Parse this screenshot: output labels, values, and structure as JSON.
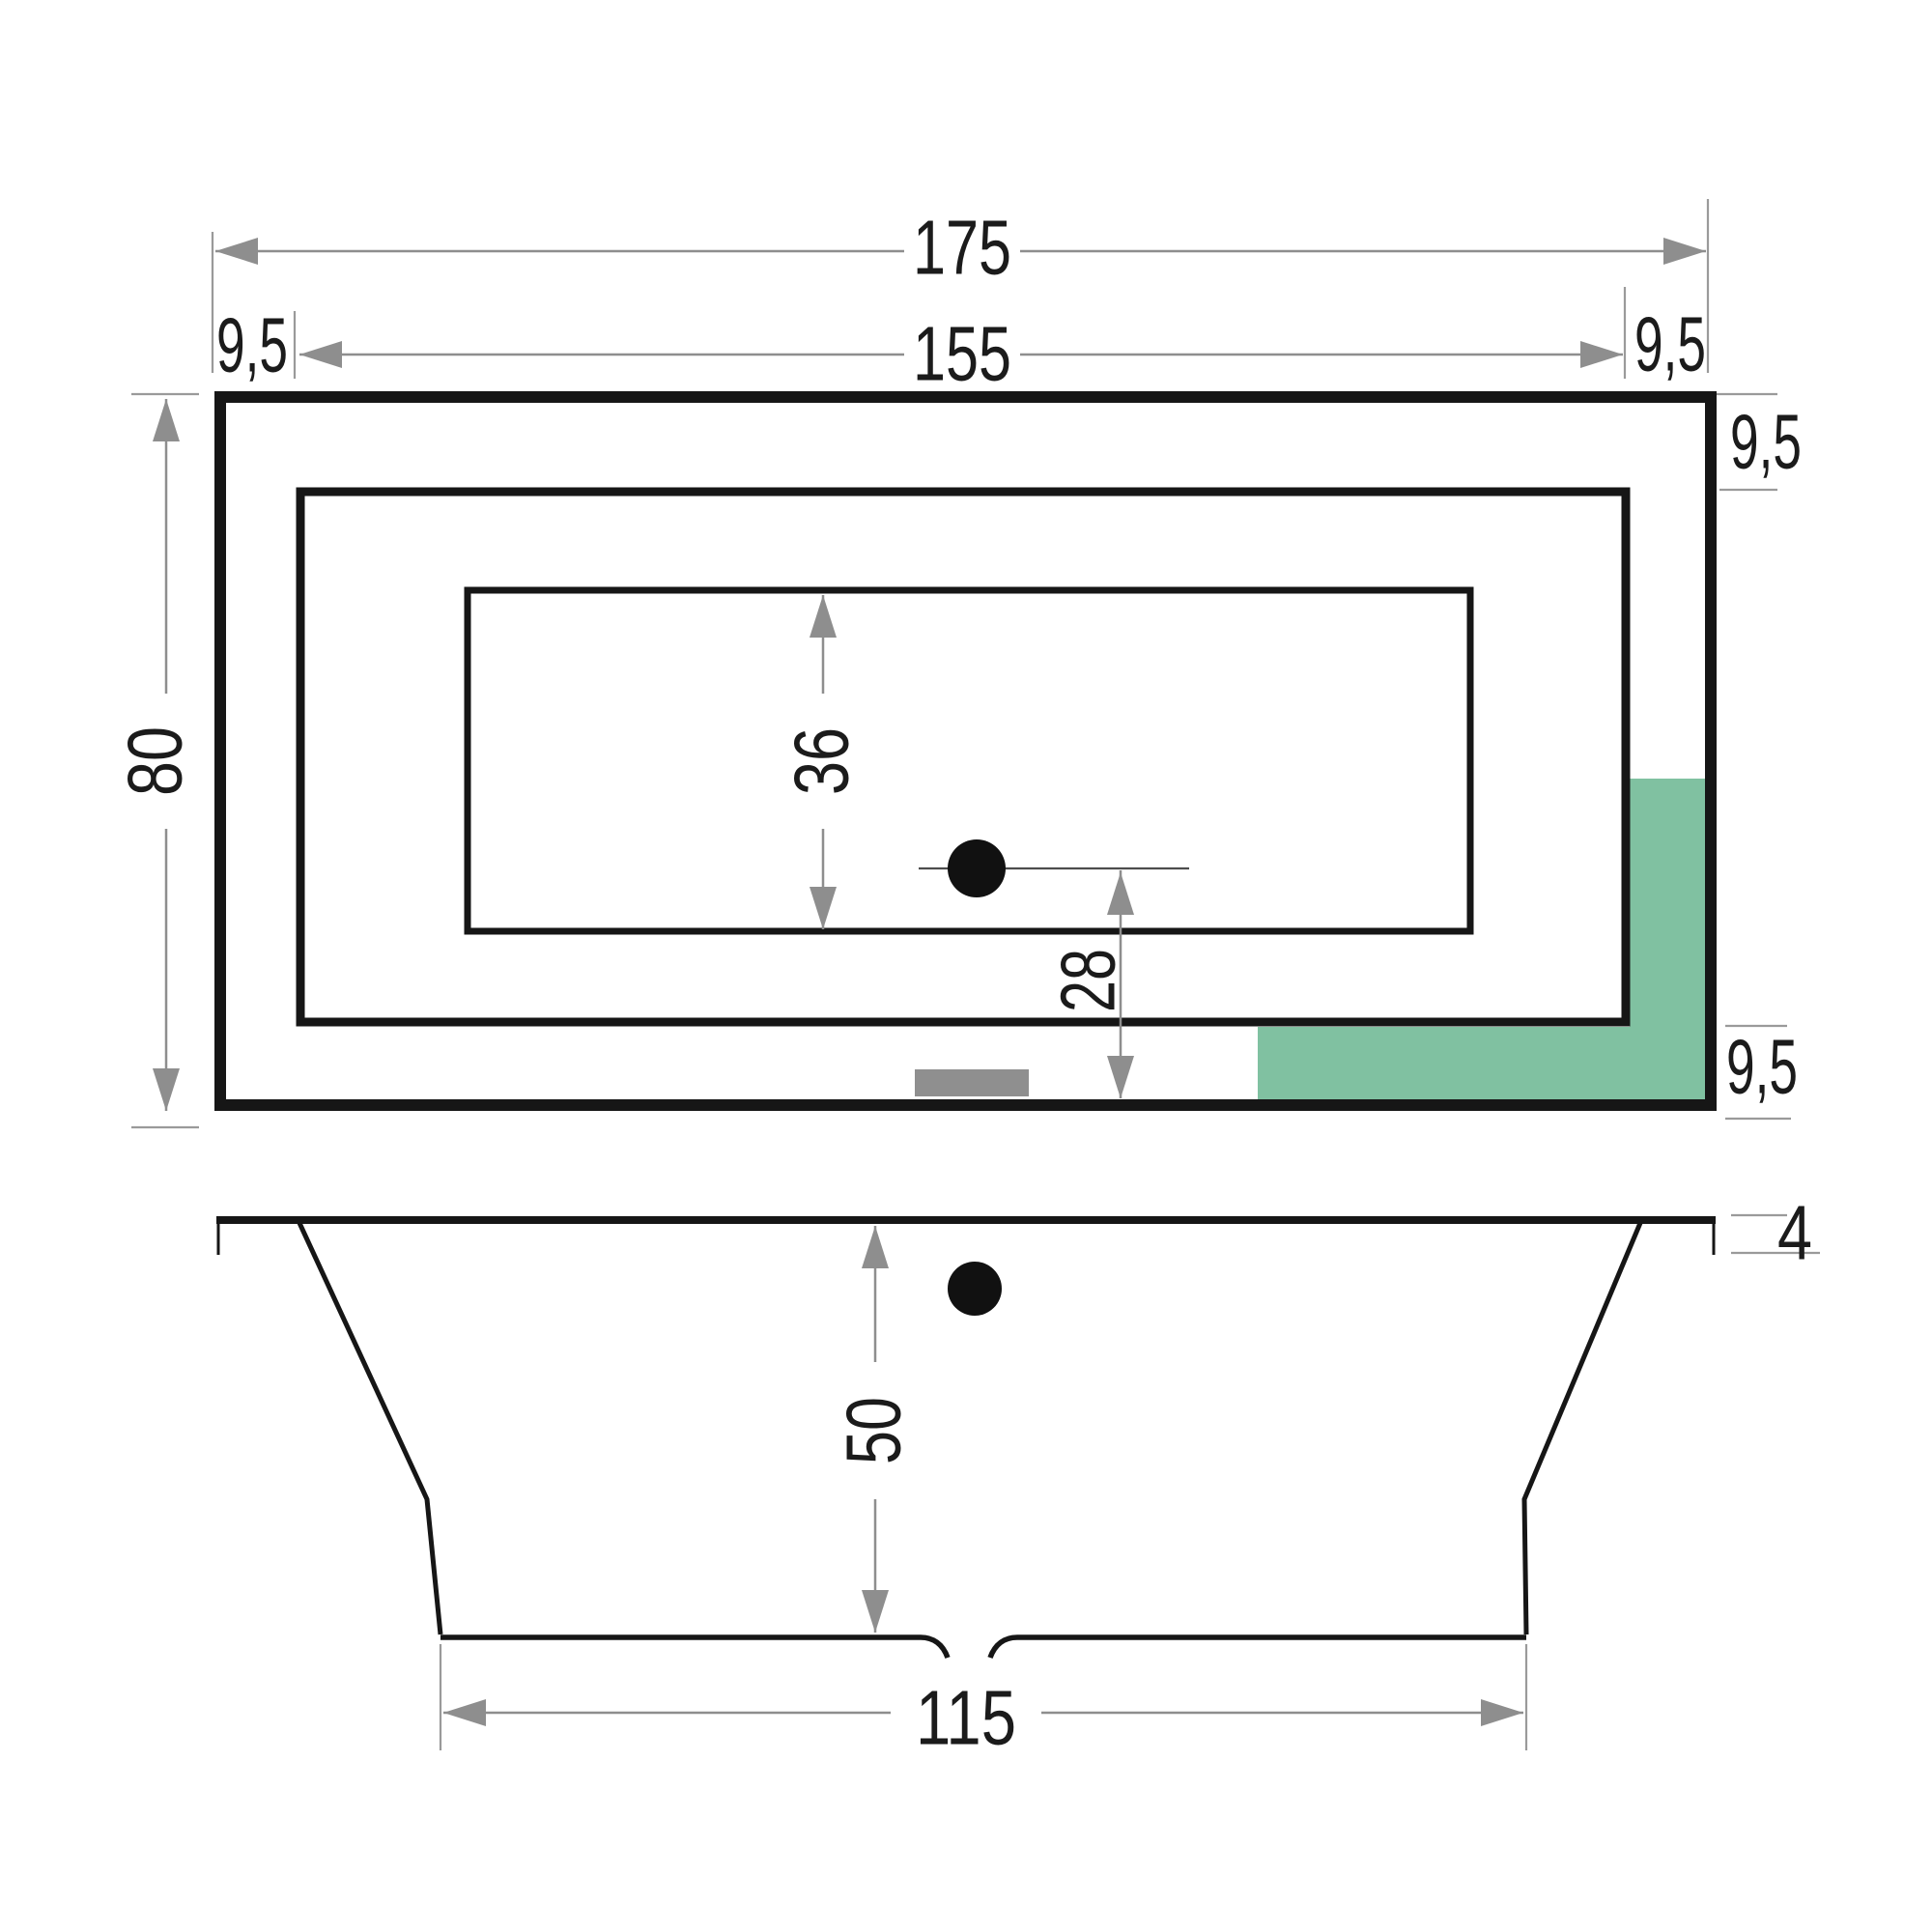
{
  "document": {
    "type": "bathtub-technical-drawing",
    "views": [
      "top-view",
      "front-view"
    ]
  },
  "colors": {
    "outline_black": "#161616",
    "dimension_gray": "#8e8e8e",
    "highlight_green": "#80c1a1",
    "overflow_gray": "#8f8f8f",
    "drain_black": "#111111",
    "background": "#ffffff",
    "text": "#1b1b1b"
  },
  "top_view": {
    "dimensions": {
      "overall_length": "175",
      "inner_length": "155",
      "rim_left": "9,5",
      "rim_right": "9,5",
      "rim_top": "9,5",
      "rim_bottom": "9,5",
      "overall_width": "80",
      "floor_width": "36",
      "drain_offset": "28"
    }
  },
  "front_view": {
    "dimensions": {
      "depth": "50",
      "floor_length": "115",
      "rim_edge_height": "4"
    }
  }
}
